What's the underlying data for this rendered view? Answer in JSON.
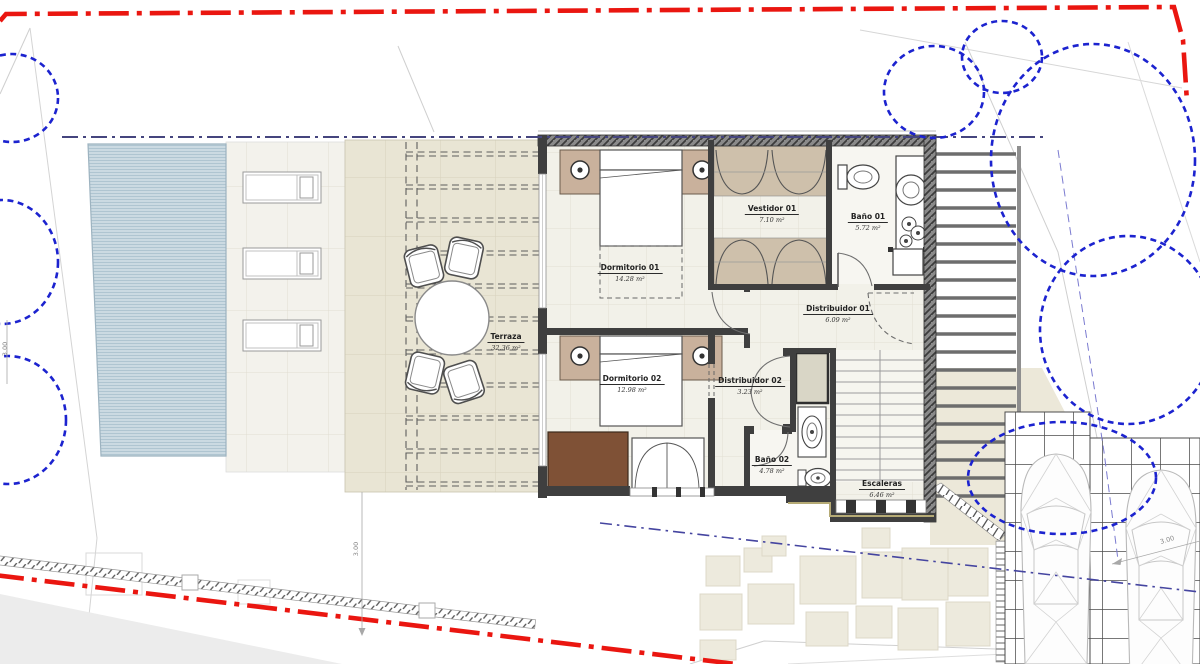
{
  "drawing": {
    "type": "architectural-floor-plan-site-plan",
    "rooms": [
      {
        "name": "Dormitorio 01",
        "area": "14.28 m²"
      },
      {
        "name": "Vestidor 01",
        "area": "7.10 m²"
      },
      {
        "name": "Baño 01",
        "area": "5.72 m²"
      },
      {
        "name": "Distribuidor 01",
        "area": "6.09 m²"
      },
      {
        "name": "Dormitorio 02",
        "area": "12.98 m²"
      },
      {
        "name": "Distribuidor 02",
        "area": "3.23 m²"
      },
      {
        "name": "Baño 02",
        "area": "4.78 m²"
      },
      {
        "name": "Escaleras",
        "area": "6.46 m²"
      },
      {
        "name": "Terraza",
        "area": "32.36 m²"
      }
    ],
    "dimensions": {
      "left": "3.00",
      "terrace": "3.00",
      "driveway": "3.00"
    },
    "colors": {
      "boundary_red": "#ea1610",
      "tree_blue": "#1c23cf",
      "setback_blue": "#45457e",
      "pool_water": "#cbdae2",
      "terrace_beige": "#e9e5d4",
      "wall_dark": "#3f3f3f"
    }
  }
}
